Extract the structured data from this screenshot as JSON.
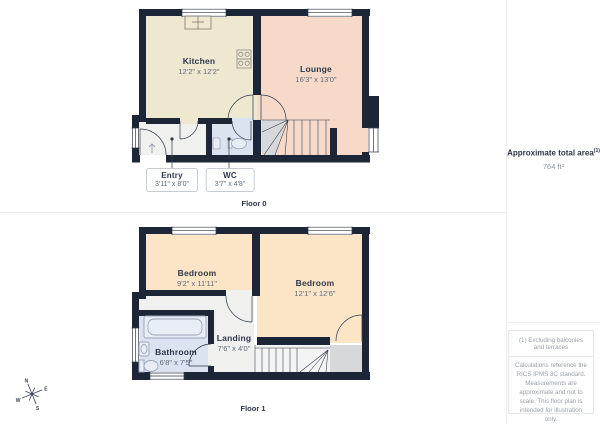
{
  "floor0": {
    "label": "Floor 0",
    "rooms": {
      "kitchen": {
        "name": "Kitchen",
        "dims": "12'2\" x 12'2\""
      },
      "lounge": {
        "name": "Lounge",
        "dims": "16'3\" x 13'0\""
      },
      "entry": {
        "name": "Entry",
        "dims": "3'11\" x 8'0\""
      },
      "wc": {
        "name": "WC",
        "dims": "3'7\" x 4'8\""
      }
    }
  },
  "floor1": {
    "label": "Floor 1",
    "rooms": {
      "bedroom_left": {
        "name": "Bedroom",
        "dims": "9'2\" x 11'11\""
      },
      "bedroom_right": {
        "name": "Bedroom",
        "dims": "12'1\" x 12'6\""
      },
      "landing": {
        "name": "Landing",
        "dims": "7'6\" x 4'0\""
      },
      "bathroom": {
        "name": "Bathroom",
        "dims": "6'8\" x 7'5\""
      }
    }
  },
  "sidebar": {
    "total_area_label": "Approximate total area",
    "total_area_marker": "(1)",
    "total_area_value": "764 ft²",
    "footnote": "(1) Excluding balconies and terraces",
    "disclaimer": "Calculations reference the RICS IPMS 3C standard. Measurements are approximate and not to scale. This floor plan is intended for illustration only.",
    "brand_light": "GIRAFFE",
    "brand_bold": "360"
  },
  "compass": {
    "north": "N",
    "east": "E",
    "south": "S",
    "west": "W"
  },
  "colors": {
    "wall": "#1c2636",
    "kitchen": "#efe8d1",
    "lounge": "#f7d9ca",
    "bedroom": "#fce5c6",
    "bathroom": "#dbe2f0",
    "hallway": "#f0f0ef",
    "stair_gray": "#d6d8da",
    "label_text": "#2d3749",
    "dims_text": "#5f6a7a"
  }
}
